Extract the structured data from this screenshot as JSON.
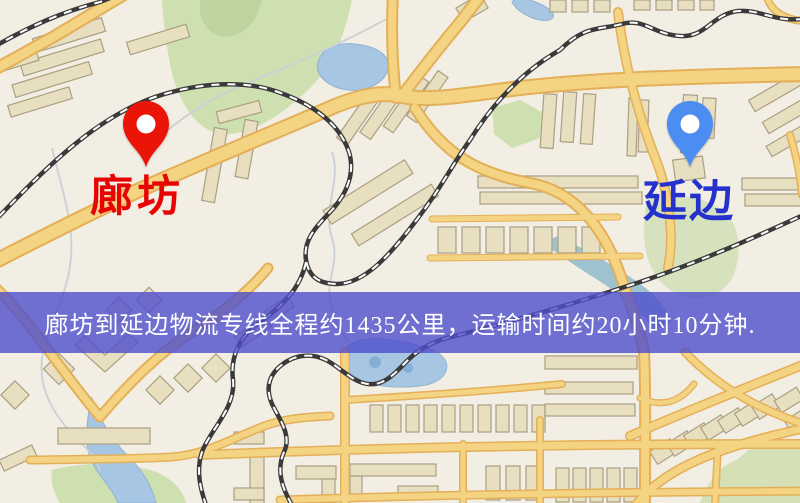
{
  "banner": {
    "text": "廊坊到延边物流专线全程约1435公里，运输时间约20小时10分钟.",
    "background_color": "#4d4dcc",
    "text_color": "#ffffff"
  },
  "markers": {
    "origin": {
      "label": "廊坊",
      "pin_color": "#ea1508",
      "label_color": "#e60404"
    },
    "destination": {
      "label": "延边",
      "pin_color": "#4b8df0",
      "label_color": "#2431cd"
    }
  },
  "map": {
    "colors": {
      "background": "#f3eee2",
      "road_fill": "#f6d37e",
      "road_casing": "#e5b054",
      "building": "#e9dfbe",
      "building_stroke": "#ab9f82",
      "park": "#cfe0ae",
      "water": "#a6c6e6",
      "railway": "#3a3a3a"
    }
  }
}
